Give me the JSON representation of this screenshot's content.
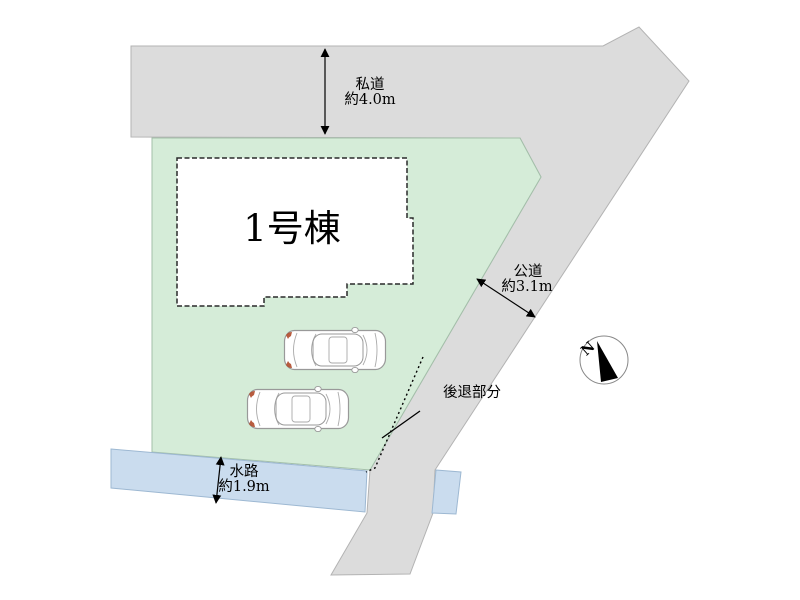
{
  "plan": {
    "type": "residential-site-plan",
    "labels": {
      "building": "1号棟",
      "private_road_name": "私道",
      "private_road_width": "約4.0m",
      "public_road_name": "公道",
      "public_road_width": "約3.1m",
      "setback": "後退部分",
      "waterway_name": "水路",
      "waterway_width": "約1.9m",
      "compass_north": "N"
    },
    "measurements": {
      "private_road_m": 4.0,
      "public_road_m": 3.1,
      "waterway_m": 1.9
    },
    "colors": {
      "plot": "#d5ecd8",
      "plot_edge": "#a3bfa9",
      "road": "#dcdcdc",
      "road_edge": "#b3b3b3",
      "water": "#cadcee",
      "water_edge": "#9db8d2",
      "building_fill": "#ffffff",
      "building_edge": "#2a2a2a",
      "line": "#000000",
      "car_outline": "#999999",
      "car_accent": "#b04a2a",
      "compass_edge": "#888888",
      "compass_needle": "#000000"
    }
  }
}
